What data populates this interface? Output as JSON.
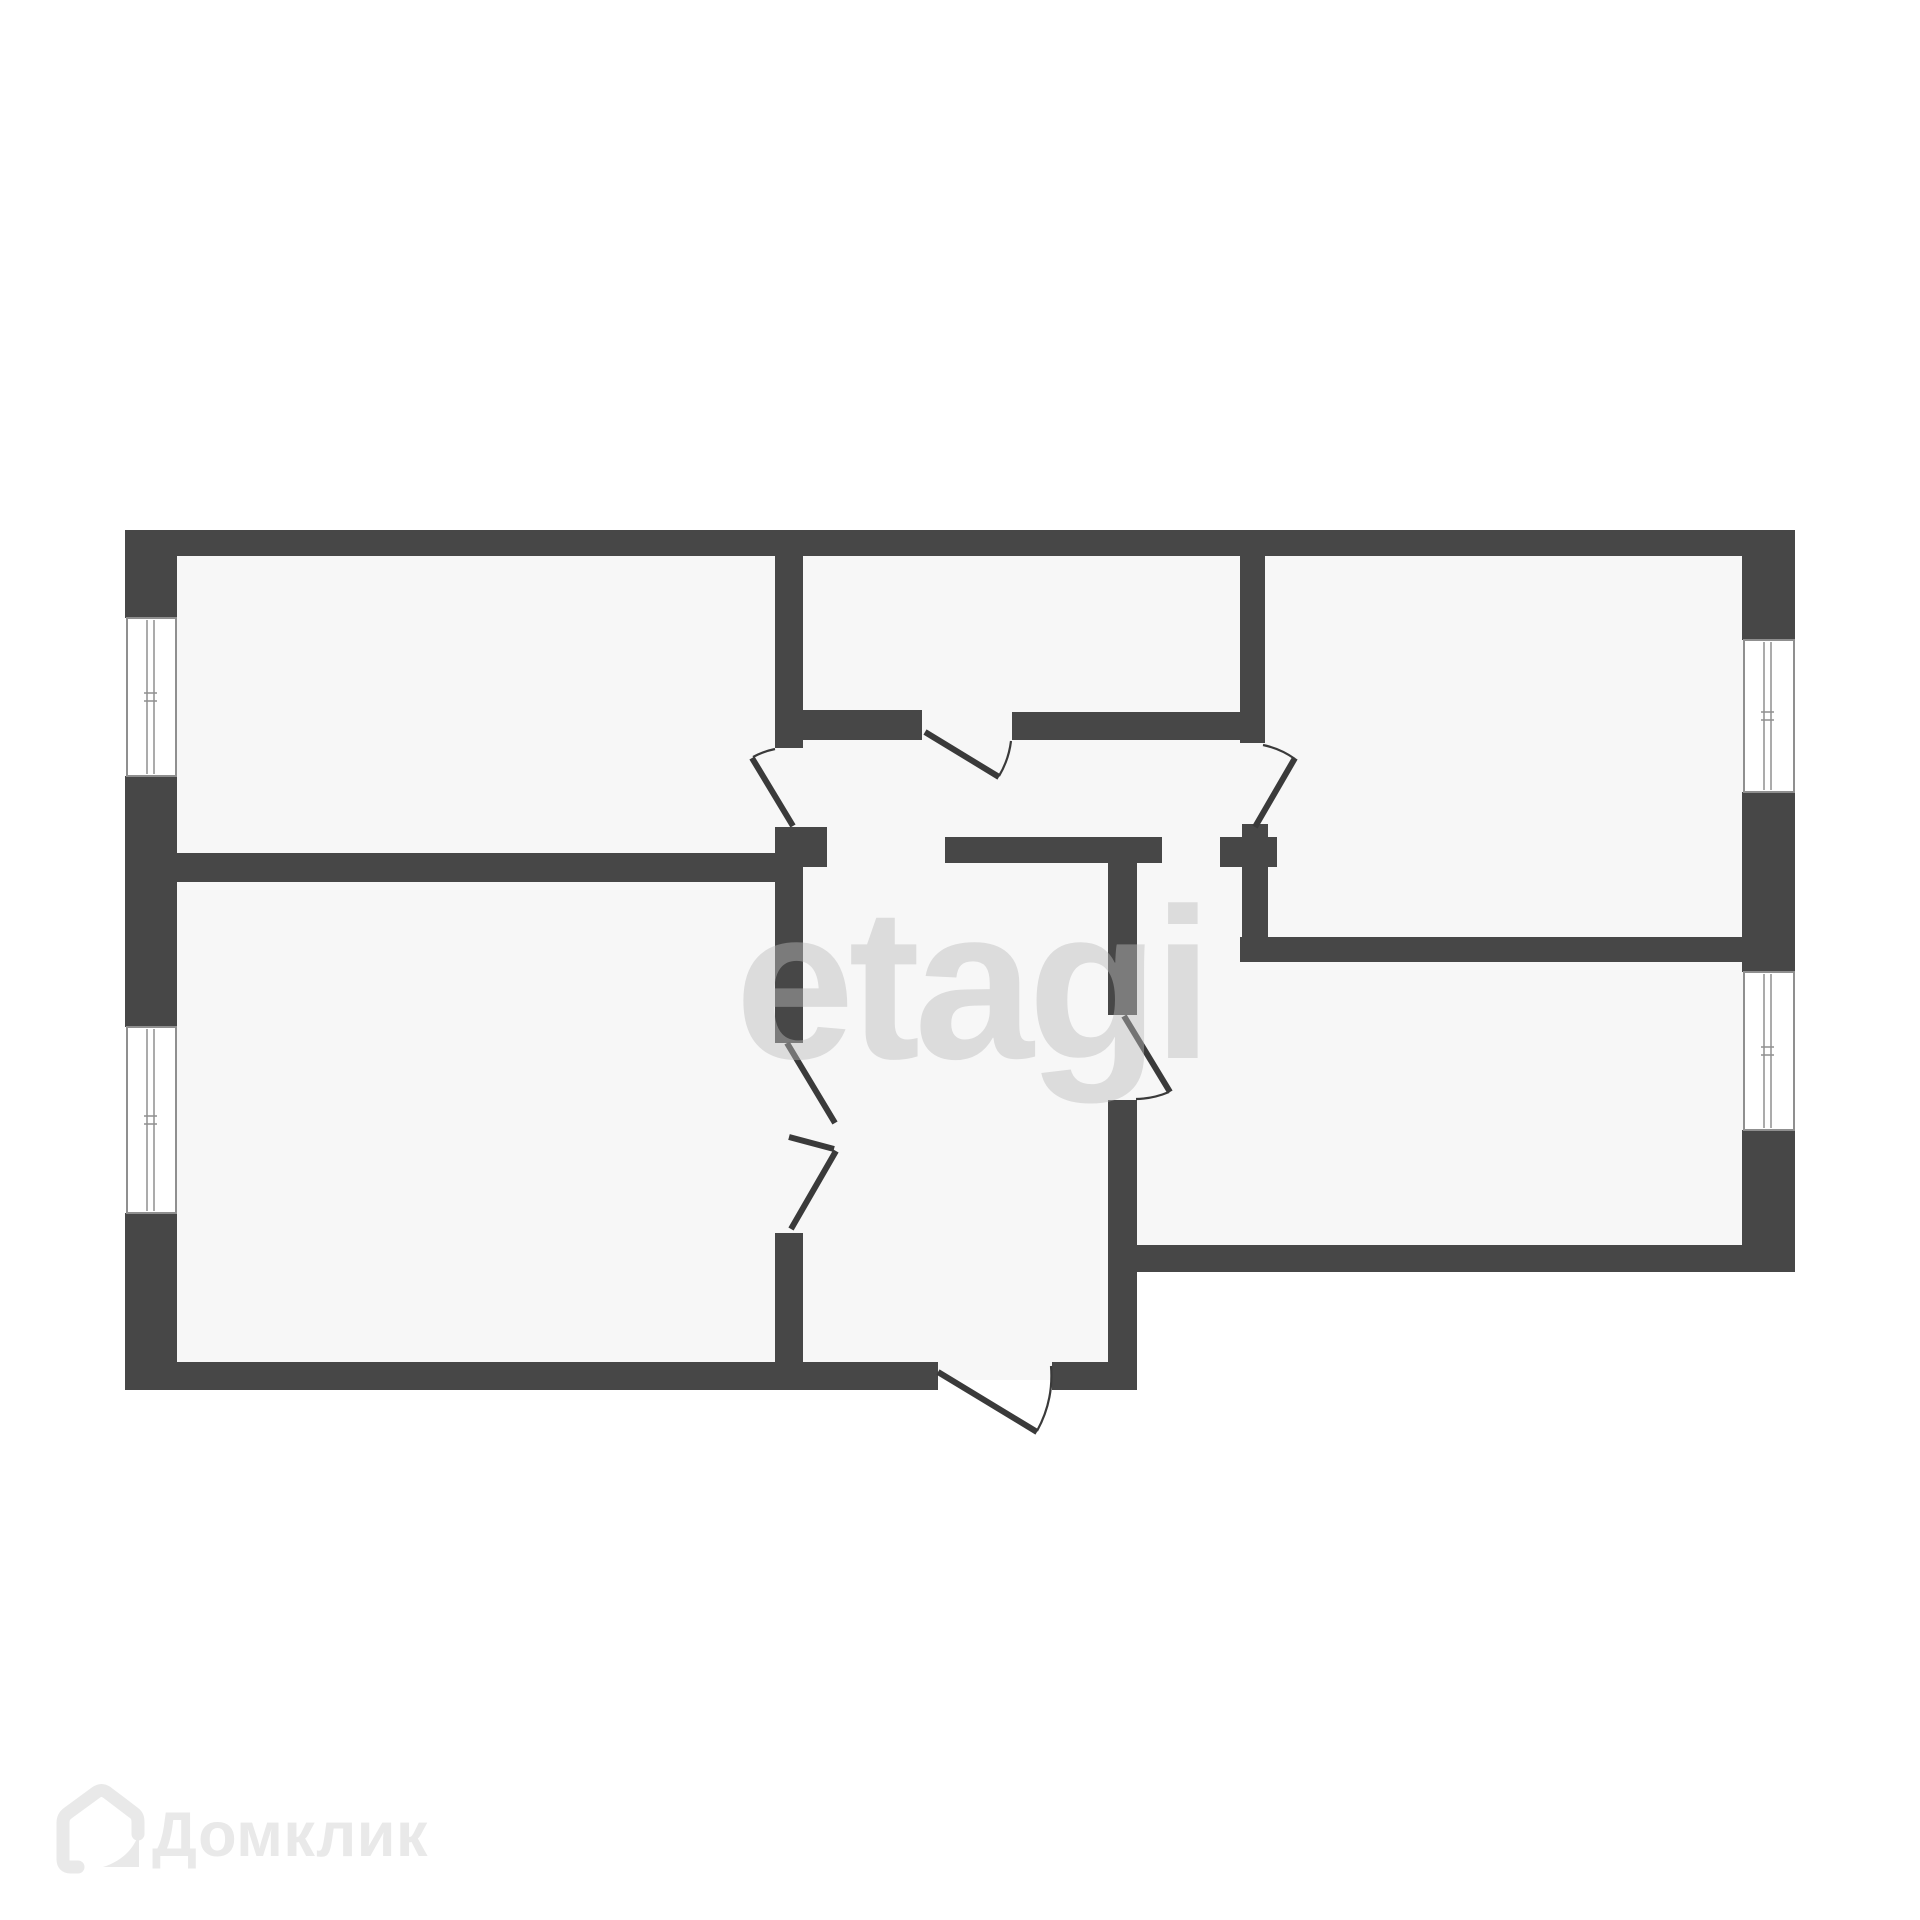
{
  "canvas": {
    "width": 1920,
    "height": 1920
  },
  "watermark": {
    "text": "etagi"
  },
  "logo": {
    "text": "Домклик",
    "icon": "house-icon"
  },
  "colors": {
    "wall": "#474747",
    "room_fill": "#f7f7f7",
    "background": "#ffffff",
    "door_line": "#3a3a3a",
    "window_frame": "#8f8f8f",
    "watermark": "#bababa",
    "watermark_opacity": "0.45",
    "logo": "#e9e9e9"
  },
  "floorplan": {
    "rooms": [
      {
        "name": "room-top-left"
      },
      {
        "name": "room-top-middle"
      },
      {
        "name": "room-top-right"
      },
      {
        "name": "room-bottom-left"
      },
      {
        "name": "room-bottom-right"
      },
      {
        "name": "hallway"
      },
      {
        "name": "entrance-hall"
      }
    ],
    "regions": [
      {
        "name": "apartment-area-main",
        "x": 140,
        "y": 540,
        "w": 1640,
        "h": 718
      },
      {
        "name": "apartment-area-left",
        "x": 140,
        "y": 540,
        "w": 983,
        "h": 840
      }
    ],
    "walls": [
      {
        "name": "wall-outer-top",
        "x": 125,
        "y": 530,
        "w": 1670,
        "h": 26
      },
      {
        "name": "wall-outer-left-upper",
        "x": 125,
        "y": 530,
        "w": 52,
        "h": 88
      },
      {
        "name": "wall-outer-left-middle",
        "x": 125,
        "y": 776,
        "w": 52,
        "h": 251
      },
      {
        "name": "wall-outer-left-lower",
        "x": 125,
        "y": 1213,
        "w": 52,
        "h": 177
      },
      {
        "name": "wall-outer-bottom-left-a",
        "x": 125,
        "y": 1362,
        "w": 813,
        "h": 28
      },
      {
        "name": "wall-outer-bottom-left-b",
        "x": 1052,
        "y": 1362,
        "w": 85,
        "h": 28
      },
      {
        "name": "wall-outer-right-upper",
        "x": 1742,
        "y": 530,
        "w": 53,
        "h": 110
      },
      {
        "name": "wall-outer-right-middle",
        "x": 1742,
        "y": 792,
        "w": 53,
        "h": 180
      },
      {
        "name": "wall-outer-right-lower",
        "x": 1742,
        "y": 1130,
        "w": 53,
        "h": 142
      },
      {
        "name": "wall-outer-bottom-right",
        "x": 1137,
        "y": 1245,
        "w": 658,
        "h": 27
      },
      {
        "name": "wall-step-vertical",
        "x": 1108,
        "y": 1100,
        "w": 29,
        "h": 290
      },
      {
        "name": "wall-top-left-room-right",
        "x": 775,
        "y": 556,
        "w": 28,
        "h": 192
      },
      {
        "name": "wall-door1-jamb",
        "x": 775,
        "y": 827,
        "w": 52,
        "h": 40
      },
      {
        "name": "wall-left-rooms-divider",
        "x": 177,
        "y": 853,
        "w": 626,
        "h": 29
      },
      {
        "name": "wall-hall-left-upper",
        "x": 775,
        "y": 882,
        "w": 28,
        "h": 161
      },
      {
        "name": "wall-hall-left-lower",
        "x": 775,
        "y": 1233,
        "w": 28,
        "h": 129
      },
      {
        "name": "wall-top-middle-bottom-left",
        "x": 803,
        "y": 710,
        "w": 119,
        "h": 30
      },
      {
        "name": "wall-top-middle-bottom-right",
        "x": 1012,
        "y": 712,
        "w": 253,
        "h": 28
      },
      {
        "name": "wall-top-right-room-left",
        "x": 1240,
        "y": 556,
        "w": 25,
        "h": 187
      },
      {
        "name": "wall-door3-nub",
        "x": 1242,
        "y": 824,
        "w": 26,
        "h": 13
      },
      {
        "name": "wall-door3-jamb",
        "x": 1220,
        "y": 837,
        "w": 57,
        "h": 30
      },
      {
        "name": "wall-top-right-stem",
        "x": 1242,
        "y": 867,
        "w": 26,
        "h": 95
      },
      {
        "name": "wall-right-rooms-divider",
        "x": 1240,
        "y": 937,
        "w": 502,
        "h": 25
      },
      {
        "name": "wall-hallway-bottom",
        "x": 945,
        "y": 837,
        "w": 217,
        "h": 26
      },
      {
        "name": "wall-entrance-right",
        "x": 1108,
        "y": 863,
        "w": 29,
        "h": 152
      }
    ],
    "windows": [
      {
        "name": "window-left-upper",
        "x": 127,
        "y": 618,
        "w": 49,
        "h": 158,
        "orientation": "v"
      },
      {
        "name": "window-left-lower",
        "x": 127,
        "y": 1027,
        "w": 49,
        "h": 186,
        "orientation": "v"
      },
      {
        "name": "window-right-upper",
        "x": 1744,
        "y": 640,
        "w": 50,
        "h": 152,
        "orientation": "v"
      },
      {
        "name": "window-right-lower",
        "x": 1744,
        "y": 972,
        "w": 50,
        "h": 158,
        "orientation": "v"
      }
    ],
    "door_leaves": [
      {
        "name": "door-top-left-room-leaf",
        "x1": 793,
        "y1": 826,
        "x2": 752,
        "y2": 758
      },
      {
        "name": "door-top-middle-room-leaf",
        "x1": 925,
        "y1": 732,
        "x2": 999,
        "y2": 777
      },
      {
        "name": "door-top-right-room-leaf",
        "x1": 1255,
        "y1": 827,
        "x2": 1295,
        "y2": 758
      },
      {
        "name": "door-bottom-right-room-leaf",
        "x1": 1124,
        "y1": 1016,
        "x2": 1170,
        "y2": 1092
      },
      {
        "name": "door-double-leaf-upper",
        "x1": 787,
        "y1": 1043,
        "x2": 835,
        "y2": 1123
      },
      {
        "name": "door-double-connector",
        "x1": 789,
        "y1": 1137,
        "x2": 834,
        "y2": 1149
      },
      {
        "name": "door-double-leaf-lower",
        "x1": 836,
        "y1": 1151,
        "x2": 791,
        "y2": 1229
      },
      {
        "name": "door-entrance-leaf",
        "x1": 938,
        "y1": 1372,
        "x2": 1037,
        "y2": 1432
      }
    ],
    "door_arcs": [
      {
        "name": "door-top-left-room-arc",
        "d": "M 775,749 A 80,80 0 0 0 753,757"
      },
      {
        "name": "door-top-middle-room-arc",
        "d": "M 1011,741 A 88,88 0 0 1 999,776"
      },
      {
        "name": "door-top-right-room-arc",
        "d": "M 1263,745 A 84,84 0 0 1 1295,759"
      },
      {
        "name": "door-bottom-right-room-arc",
        "d": "M 1136,1099 A 88,88 0 0 0 1169,1092"
      },
      {
        "name": "door-entrance-arc",
        "d": "M 1051,1366 A 115,115 0 0 1 1037,1431"
      }
    ]
  }
}
